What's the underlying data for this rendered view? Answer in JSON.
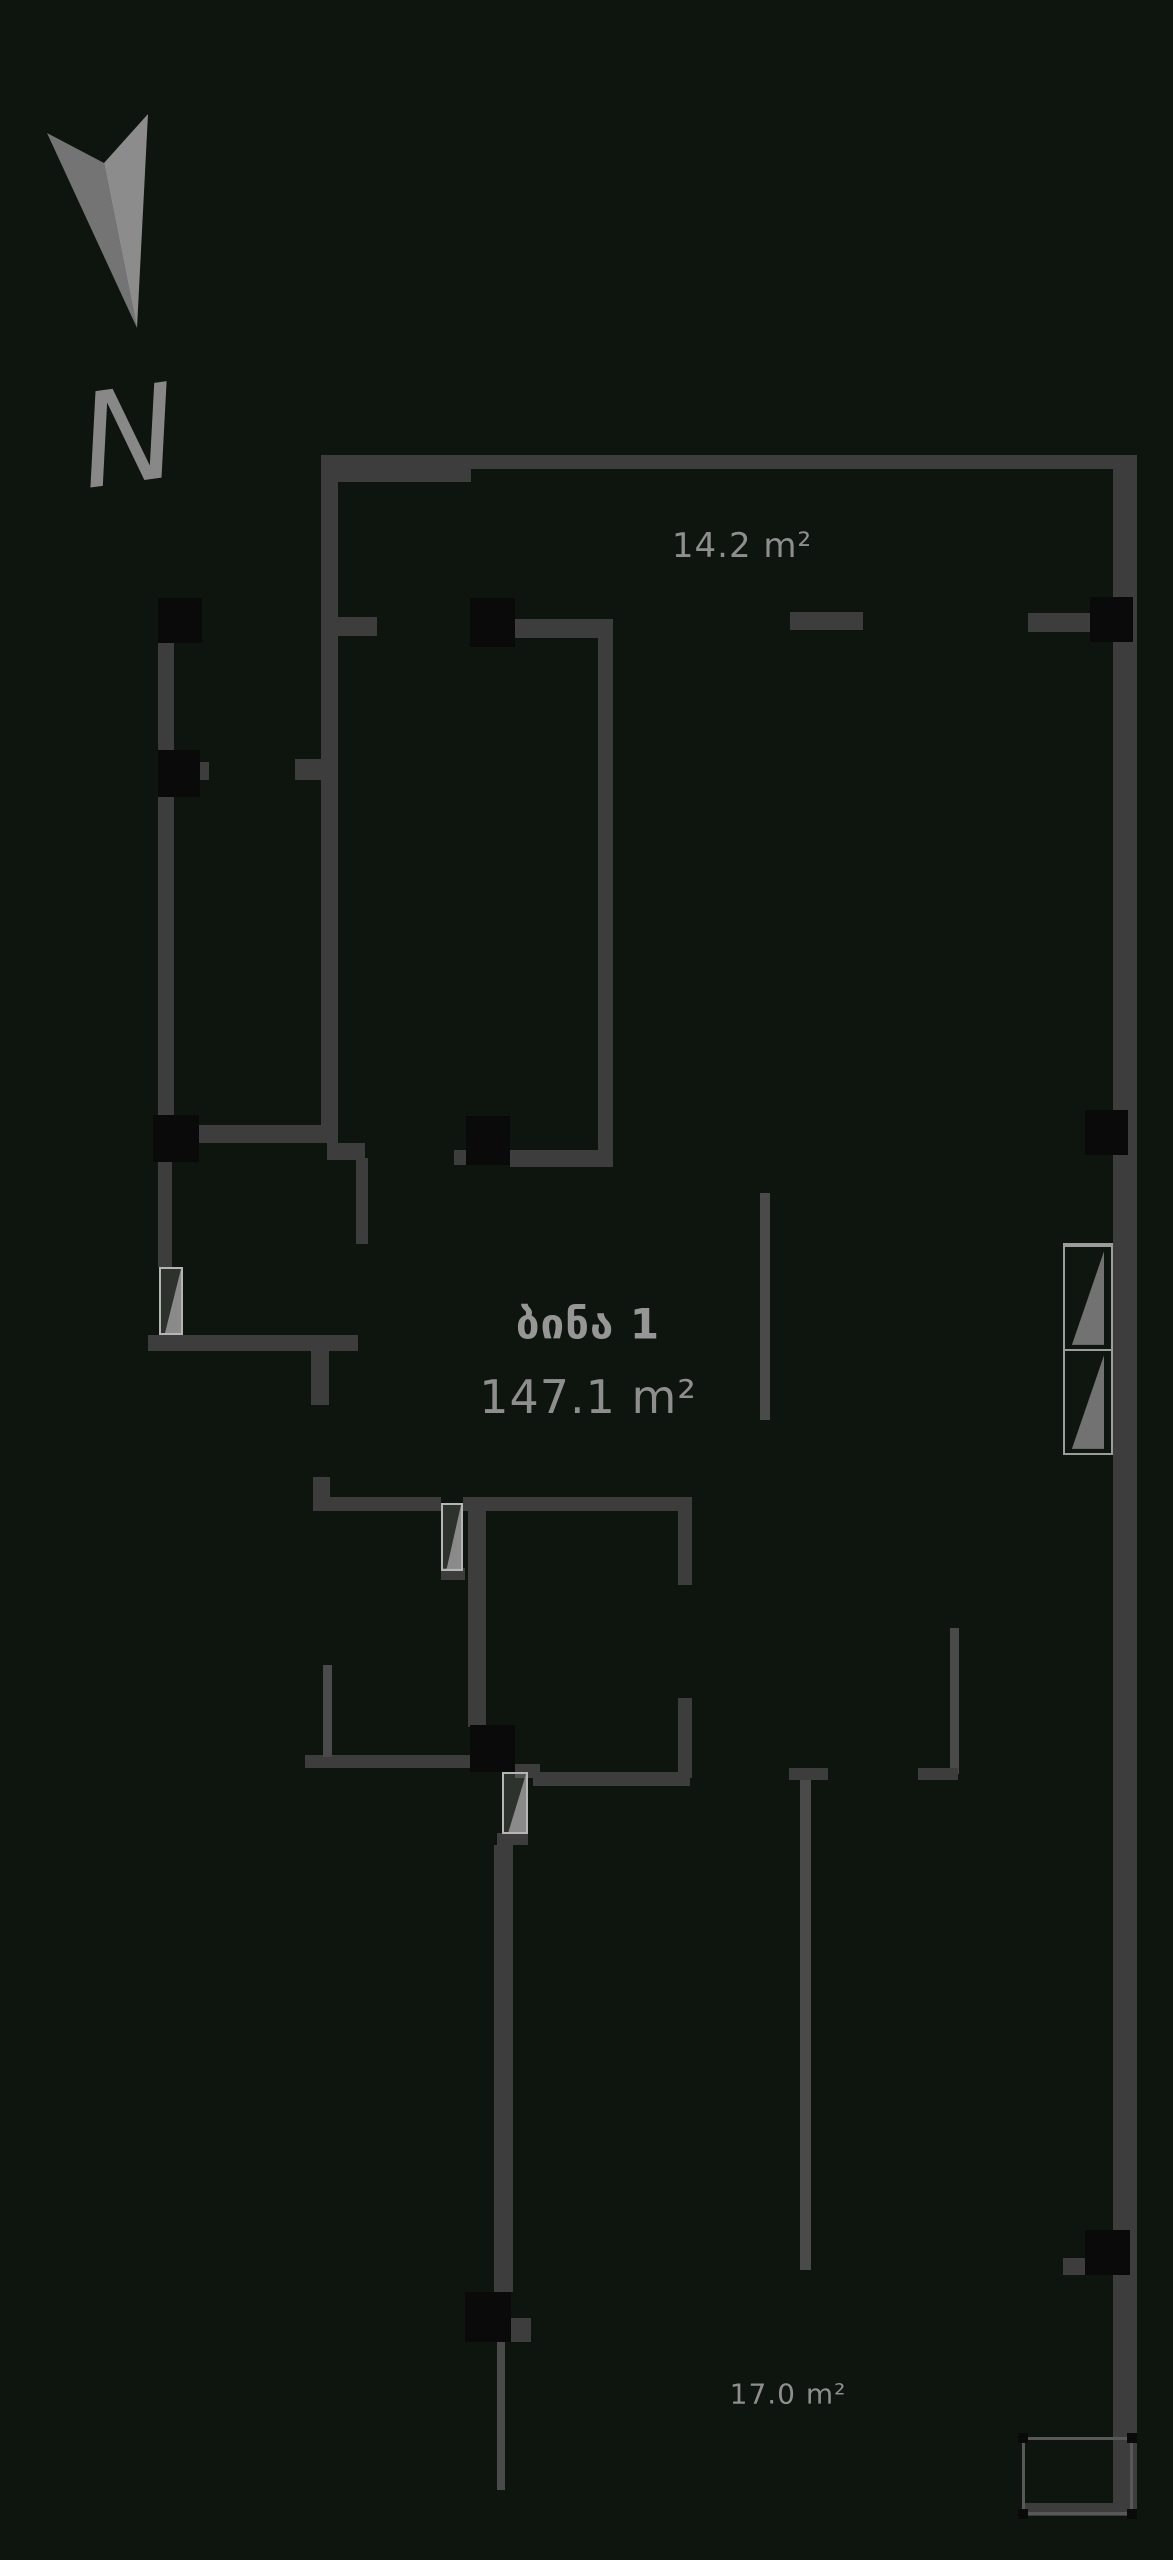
{
  "title": "apartment-floor-plan",
  "compass": {
    "label": "N"
  },
  "apartment": {
    "name": "ბინა 1",
    "area": "147.1 m²"
  },
  "rooms": [
    {
      "id": "top-balcony",
      "label": "14.2 m²"
    },
    {
      "id": "bottom-balcony",
      "label": "17.0 m²"
    }
  ],
  "colors": {
    "background": "#0e140e",
    "wall": "#3d3d3d",
    "wall_thin": "#4a4a4a",
    "column": "#0a0a0a",
    "door": "#b5b5b5",
    "window_frame": "#9c9c9c",
    "label_text": "#8e8e8e",
    "compass_arrow_dark": "#747474",
    "compass_arrow_light": "#8c8c8c"
  },
  "plan": {
    "walls": [
      {
        "x": 321,
        "y": 455,
        "w": 150,
        "h": 27
      },
      {
        "x": 471,
        "y": 455,
        "w": 666,
        "h": 14
      },
      {
        "x": 1113,
        "y": 458,
        "w": 24,
        "h": 2055
      },
      {
        "x": 321,
        "y": 455,
        "w": 17,
        "h": 688
      },
      {
        "x": 338,
        "y": 617,
        "w": 39,
        "h": 19
      },
      {
        "x": 158,
        "y": 598,
        "w": 16,
        "h": 564
      },
      {
        "x": 200,
        "y": 762,
        "w": 9,
        "h": 18
      },
      {
        "x": 295,
        "y": 759,
        "w": 26,
        "h": 21
      },
      {
        "x": 199,
        "y": 1125,
        "w": 128,
        "h": 18
      },
      {
        "x": 327,
        "y": 1143,
        "w": 38,
        "h": 17
      },
      {
        "x": 356,
        "y": 1158,
        "w": 12,
        "h": 86
      },
      {
        "x": 515,
        "y": 619,
        "w": 98,
        "h": 19
      },
      {
        "x": 598,
        "y": 638,
        "w": 15,
        "h": 517
      },
      {
        "x": 510,
        "y": 1150,
        "w": 103,
        "h": 17
      },
      {
        "x": 454,
        "y": 1150,
        "w": 12,
        "h": 15
      },
      {
        "x": 790,
        "y": 612,
        "w": 73,
        "h": 18
      },
      {
        "x": 1028,
        "y": 613,
        "w": 62,
        "h": 19
      },
      {
        "x": 158,
        "y": 1162,
        "w": 14,
        "h": 105
      },
      {
        "x": 148,
        "y": 1335,
        "w": 210,
        "h": 16
      },
      {
        "x": 311,
        "y": 1351,
        "w": 18,
        "h": 54
      },
      {
        "x": 760,
        "y": 1193,
        "w": 10,
        "h": 227,
        "thin": 1
      },
      {
        "x": 313,
        "y": 1477,
        "w": 17,
        "h": 22
      },
      {
        "x": 313,
        "y": 1497,
        "w": 128,
        "h": 14
      },
      {
        "x": 441,
        "y": 1568,
        "w": 24,
        "h": 12
      },
      {
        "x": 463,
        "y": 1497,
        "w": 227,
        "h": 14
      },
      {
        "x": 468,
        "y": 1511,
        "w": 18,
        "h": 216
      },
      {
        "x": 678,
        "y": 1497,
        "w": 14,
        "h": 88
      },
      {
        "x": 678,
        "y": 1698,
        "w": 14,
        "h": 80
      },
      {
        "x": 515,
        "y": 1764,
        "w": 25,
        "h": 14
      },
      {
        "x": 533,
        "y": 1772,
        "w": 157,
        "h": 14
      },
      {
        "x": 305,
        "y": 1755,
        "w": 165,
        "h": 13
      },
      {
        "x": 323,
        "y": 1665,
        "w": 9,
        "h": 92,
        "thin": 1
      },
      {
        "x": 497,
        "y": 1833,
        "w": 31,
        "h": 12
      },
      {
        "x": 494,
        "y": 1845,
        "w": 19,
        "h": 447
      },
      {
        "x": 511,
        "y": 2318,
        "w": 20,
        "h": 24
      },
      {
        "x": 497,
        "y": 2342,
        "w": 8,
        "h": 148,
        "thin": 1
      },
      {
        "x": 950,
        "y": 1628,
        "w": 9,
        "h": 146,
        "thin": 1
      },
      {
        "x": 918,
        "y": 1768,
        "w": 40,
        "h": 12
      },
      {
        "x": 789,
        "y": 1768,
        "w": 39,
        "h": 12
      },
      {
        "x": 800,
        "y": 1780,
        "w": 11,
        "h": 490,
        "thin": 1
      },
      {
        "x": 1063,
        "y": 2258,
        "w": 22,
        "h": 17
      },
      {
        "x": 1022,
        "y": 2503,
        "w": 115,
        "h": 13
      }
    ],
    "columns": [
      {
        "x": 158,
        "y": 598,
        "w": 44,
        "h": 45
      },
      {
        "x": 158,
        "y": 750,
        "w": 42,
        "h": 47
      },
      {
        "x": 470,
        "y": 598,
        "w": 45,
        "h": 49
      },
      {
        "x": 1090,
        "y": 597,
        "w": 43,
        "h": 45
      },
      {
        "x": 153,
        "y": 1115,
        "w": 46,
        "h": 47
      },
      {
        "x": 466,
        "y": 1116,
        "w": 44,
        "h": 49
      },
      {
        "x": 1085,
        "y": 1110,
        "w": 43,
        "h": 45
      },
      {
        "x": 470,
        "y": 1725,
        "w": 45,
        "h": 47
      },
      {
        "x": 465,
        "y": 2292,
        "w": 46,
        "h": 50
      },
      {
        "x": 1085,
        "y": 2230,
        "w": 45,
        "h": 45
      }
    ],
    "doors": [
      {
        "x": 159,
        "y": 1267,
        "w": 24,
        "h": 68
      },
      {
        "x": 441,
        "y": 1503,
        "w": 22,
        "h": 68
      },
      {
        "x": 502,
        "y": 1772,
        "w": 26,
        "h": 62
      }
    ],
    "windows": [
      {
        "x": 1063,
        "y": 1243,
        "w": 50,
        "h": 212,
        "panes": 2
      }
    ],
    "railings": [
      {
        "x": 1022,
        "y": 2437,
        "w": 111,
        "h": 78
      }
    ]
  }
}
